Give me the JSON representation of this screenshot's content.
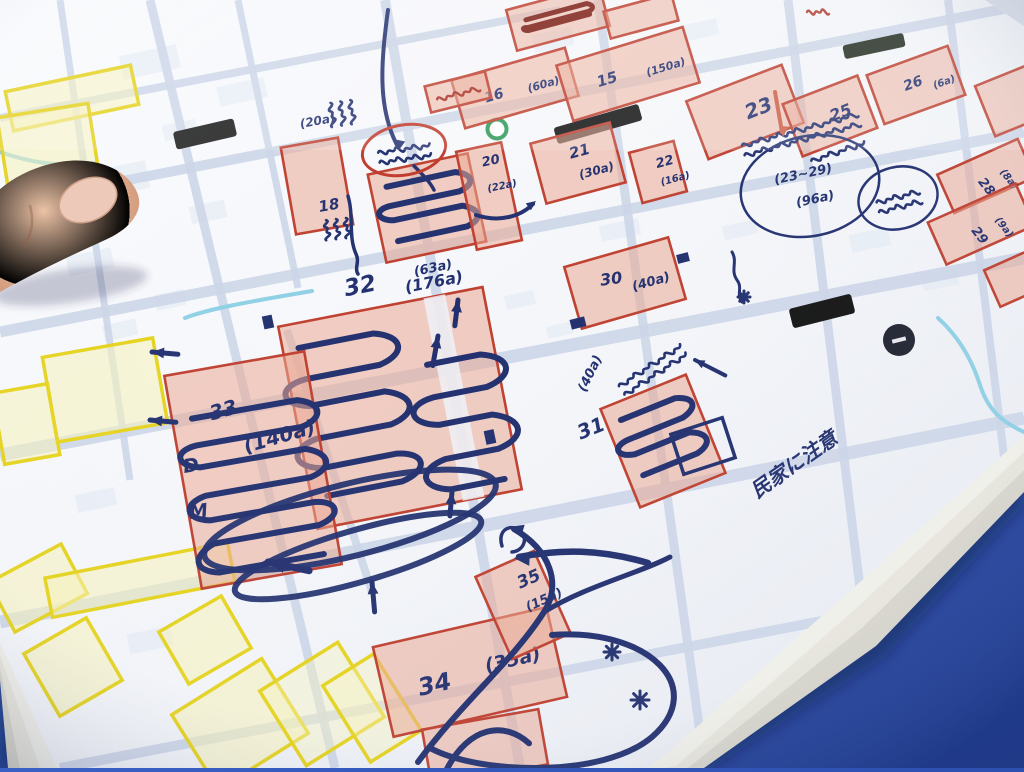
{
  "scene": {
    "description_labels": {
      "house_note": "民家に注意",
      "circle_note_line1": "(23~29)",
      "circle_note_line2": "(96a)",
      "letter_d": "D",
      "letter_m": "M"
    },
    "colors": {
      "table_blue": "#2a4cae",
      "paper": "#f6f7fa",
      "road": "#ccd6e8",
      "river": "#8fd0e6",
      "pink_fill": "#eba792",
      "pink_border": "#bf4030",
      "yellow_fill": "#f8f2b8",
      "yellow_border": "#e6d31d",
      "ink_navy": "#22306f",
      "red_ink": "#c0392b",
      "dark_red_marker": "#7c1d12"
    }
  },
  "map": {
    "parcels": [
      {
        "num": "16",
        "area": "(60a)",
        "cx": 515,
        "cy": 88,
        "w": 118,
        "h": 50,
        "rot": -16,
        "numPos": [
          -32,
          6,
          14,
          0
        ],
        "areaPos": [
          12,
          8,
          11,
          0
        ]
      },
      {
        "num": "15",
        "area": "(150a)",
        "cx": 628,
        "cy": 74,
        "w": 132,
        "h": 58,
        "rot": -17,
        "numPos": [
          -32,
          4,
          15,
          0
        ],
        "areaPos": [
          18,
          8,
          11,
          0
        ]
      },
      {
        "num": "18",
        "area": "(20a)",
        "cx": 317,
        "cy": 186,
        "w": 58,
        "h": 88,
        "rot": -10,
        "numPos": [
          -2,
          26,
          15,
          0
        ],
        "areaPos": [
          -6,
          -60,
          12,
          0
        ]
      },
      {
        "num": "",
        "area": "(63a)",
        "cx": 427,
        "cy": 208,
        "w": 102,
        "h": 90,
        "rot": -12,
        "areaPos": [
          -26,
          64,
          13,
          0
        ],
        "scribbles": [
          {
            "dx": 0,
            "dy": -2,
            "w": 86,
            "h": 70,
            "runs": 4
          }
        ]
      },
      {
        "num": "20",
        "area": "(22a)",
        "cx": 489,
        "cy": 196,
        "w": 46,
        "h": 100,
        "rot": -12,
        "numPos": [
          0,
          -30,
          13,
          0
        ],
        "areaPos": [
          0,
          -4,
          10,
          0
        ]
      },
      {
        "num": "21",
        "area": "(30a)",
        "cx": 578,
        "cy": 163,
        "w": 82,
        "h": 62,
        "rot": -15,
        "numPos": [
          -6,
          -6,
          15,
          0
        ],
        "areaPos": [
          -2,
          16,
          12,
          0
        ]
      },
      {
        "num": "22",
        "area": "(16a)",
        "cx": 658,
        "cy": 172,
        "w": 46,
        "h": 52,
        "rot": -15,
        "numPos": [
          0,
          -4,
          13,
          0
        ],
        "areaPos": [
          0,
          14,
          10,
          0
        ]
      },
      {
        "num": "23",
        "area": "",
        "cx": 745,
        "cy": 112,
        "w": 102,
        "h": 62,
        "rot": -21,
        "numPos": [
          0,
          8,
          20,
          0
        ]
      },
      {
        "num": "25",
        "area": "",
        "cx": 830,
        "cy": 116,
        "w": 80,
        "h": 56,
        "rot": -21,
        "numPos": [
          0,
          6,
          16,
          0
        ]
      },
      {
        "num": "26",
        "area": "(6a)",
        "cx": 916,
        "cy": 85,
        "w": 86,
        "h": 52,
        "rot": -20,
        "numPos": [
          -12,
          2,
          14,
          0
        ],
        "areaPos": [
          16,
          10,
          10,
          0
        ]
      },
      {
        "num": "28",
        "area": "(8a)",
        "cx": 986,
        "cy": 176,
        "w": 88,
        "h": 42,
        "rot": -24,
        "numPos": [
          -10,
          2,
          13,
          76
        ],
        "areaPos": [
          14,
          2,
          10,
          76
        ]
      },
      {
        "num": "29",
        "area": "(9a)",
        "cx": 981,
        "cy": 224,
        "w": 96,
        "h": 46,
        "rot": -24,
        "numPos": [
          -12,
          2,
          13,
          76
        ],
        "areaPos": [
          14,
          2,
          10,
          76
        ]
      },
      {
        "num": "",
        "area": "",
        "cx": 1013,
        "cy": 100,
        "w": 60,
        "h": 54,
        "rot": -22
      },
      {
        "num": "30",
        "area": "(40a)",
        "cx": 625,
        "cy": 283,
        "w": 108,
        "h": 64,
        "rot": -16,
        "numPos": [
          -24,
          -4,
          16,
          8
        ],
        "areaPos": [
          6,
          10,
          13,
          0
        ]
      },
      {
        "num": "31",
        "area": "(40a)",
        "cx": 663,
        "cy": 441,
        "w": 92,
        "h": 106,
        "rot": -22,
        "numPos": [
          -76,
          -32,
          20,
          0
        ],
        "areaPos": [
          -54,
          -74,
          13,
          -42
        ],
        "scribbles": [
          {
            "dx": -2,
            "dy": -6,
            "w": 74,
            "h": 74,
            "runs": 4
          }
        ]
      },
      {
        "num": "32",
        "area": "(176a)",
        "cx": 400,
        "cy": 408,
        "w": 208,
        "h": 206,
        "rot": -11,
        "numPos": [
          -32,
          -120,
          23,
          0
        ],
        "areaPos": [
          28,
          -112,
          16,
          0
        ],
        "gap": true,
        "scribbles": [
          {
            "dx": -50,
            "dy": -2,
            "w": 92,
            "h": 168,
            "runs": 6
          },
          {
            "dx": 62,
            "dy": 26,
            "w": 70,
            "h": 142,
            "runs": 5
          }
        ]
      },
      {
        "num": "33",
        "area": "(140a)",
        "cx": 253,
        "cy": 470,
        "w": 142,
        "h": 216,
        "rot": -10,
        "numPos": [
          -32,
          -56,
          20,
          -6
        ],
        "areaPos": [
          -4,
          -18,
          20,
          -6
        ],
        "scribbles": [
          {
            "dx": 2,
            "dy": 16,
            "w": 122,
            "h": 170,
            "runs": 7
          }
        ]
      },
      {
        "num": "34",
        "area": "(35a)",
        "cx": 470,
        "cy": 672,
        "w": 178,
        "h": 92,
        "rot": -13,
        "numPos": [
          -54,
          12,
          24,
          0
        ],
        "areaPos": [
          16,
          4,
          19,
          0
        ]
      },
      {
        "num": "35",
        "area": "(15a)",
        "cx": 523,
        "cy": 605,
        "w": 64,
        "h": 90,
        "rot": -24,
        "numPos": [
          4,
          -16,
          17,
          0
        ],
        "areaPos": [
          2,
          8,
          13,
          0
        ]
      },
      {
        "num": "",
        "area": "",
        "cx": 558,
        "cy": 18,
        "w": 96,
        "h": 42,
        "rot": -15,
        "darkScribble": true
      },
      {
        "num": "",
        "area": "",
        "cx": 641,
        "cy": 16,
        "w": 70,
        "h": 28,
        "rot": -15
      },
      {
        "num": "",
        "area": "",
        "cx": 458,
        "cy": 92,
        "w": 62,
        "h": 27,
        "rot": -14,
        "redText": true
      },
      {
        "num": "",
        "area": "",
        "cx": 485,
        "cy": 747,
        "w": 118,
        "h": 56,
        "rot": -10,
        "arc": true
      },
      {
        "num": "",
        "area": "",
        "cx": 1016,
        "cy": 278,
        "w": 52,
        "h": 40,
        "rot": -24
      }
    ],
    "yellow_parcels": [
      [
        72,
        98,
        128,
        40,
        -12
      ],
      [
        50,
        158,
        92,
        96,
        -9
      ],
      [
        105,
        390,
        112,
        86,
        -10
      ],
      [
        26,
        424,
        56,
        72,
        -10
      ],
      [
        38,
        588,
        82,
        56,
        -28
      ],
      [
        140,
        580,
        186,
        40,
        -11
      ],
      [
        73,
        667,
        72,
        72,
        -30
      ],
      [
        205,
        640,
        72,
        60,
        -30
      ],
      [
        240,
        724,
        106,
        88,
        -32
      ],
      [
        322,
        704,
        92,
        88,
        -32,
        0.4
      ],
      [
        372,
        708,
        60,
        90,
        -32,
        0.4
      ]
    ],
    "roads": [
      [
        0,
        205,
        1024,
        5,
        10
      ],
      [
        0,
        118,
        560,
        10,
        8
      ],
      [
        0,
        332,
        1024,
        132,
        11
      ],
      [
        0,
        455,
        1024,
        258,
        13
      ],
      [
        0,
        622,
        1024,
        418,
        13
      ],
      [
        60,
        768,
        1024,
        582,
        10
      ],
      [
        150,
        0,
        335,
        768,
        9
      ],
      [
        385,
        0,
        520,
        768,
        10
      ],
      [
        287,
        330,
        372,
        592,
        8
      ],
      [
        598,
        0,
        705,
        768,
        9
      ],
      [
        788,
        0,
        882,
        768,
        9
      ],
      [
        948,
        0,
        1024,
        620,
        8
      ],
      [
        60,
        0,
        130,
        480,
        7
      ],
      [
        238,
        0,
        298,
        288,
        7
      ]
    ],
    "rivers": [
      "M185,318 C210,308 260,300 312,291",
      "M938,318 C958,336 972,360 980,385 C988,410 1002,422 1024,432",
      "M0,152 C24,160 52,168 96,163"
    ],
    "bars": [
      [
        205,
        134,
        62,
        18,
        -13,
        "#141414"
      ],
      [
        598,
        124,
        88,
        17,
        -16,
        "#101010"
      ],
      [
        822,
        311,
        64,
        20,
        -14,
        "#141414"
      ],
      [
        874,
        46,
        62,
        14,
        -12,
        "#20291c"
      ]
    ],
    "green_circle": [
      497,
      129,
      9.5
    ],
    "dark_circle": [
      899,
      340,
      16
    ],
    "red_arrow": {
      "line": [
        775,
        92,
        782,
        132
      ],
      "head": [
        783,
        137,
        95
      ]
    },
    "routes": [
      {
        "d": "M388,10 C381,62 377,108 398,147",
        "w": 4,
        "head": [
          399,
          150,
          102
        ]
      },
      {
        "d": "M414,166 C424,176 430,182 434,190",
        "w": 3.5
      },
      {
        "d": "M418,762 C464,700 512,662 544,612 C562,584 550,550 514,529",
        "w": 6,
        "head": [
          509,
          527,
          196
        ]
      },
      {
        "d": "M544,612 C586,586 640,573 670,557",
        "w": 5
      },
      {
        "d": "M648,563 C600,549 561,549 519,557",
        "w": 6.5,
        "head": [
          514,
          558,
          183
        ]
      },
      {
        "d": "M552,635 C650,628 708,688 652,737 C602,779 478,774 430,748",
        "w": 6
      },
      {
        "d": "M476,215 C500,223 521,216 533,204",
        "w": 4,
        "head": [
          536,
          201,
          -37
        ]
      },
      {
        "d": "M502,546 C497,530 510,523 520,531 C529,539 523,551 512,552",
        "w": 3.5
      },
      {
        "d": "M732,252 C738,262 730,270 737,280 C743,288 736,294 742,302",
        "w": 3
      },
      {
        "d": "M348,196 C354,216 348,236 356,254 C360,262 354,268 358,274",
        "w": 3.5
      }
    ],
    "arrows": [
      [
        152,
        352,
        185,
        26,
        5
      ],
      [
        150,
        420,
        185,
        26,
        5
      ],
      [
        268,
        562,
        192,
        42,
        7
      ],
      [
        438,
        336,
        -80,
        30,
        5
      ],
      [
        458,
        300,
        -83,
        26,
        5
      ],
      [
        372,
        582,
        -95,
        30,
        5
      ],
      [
        695,
        360,
        207,
        34,
        4
      ],
      [
        452,
        492,
        -85,
        24,
        5
      ]
    ],
    "asterisks": [
      [
        612,
        652,
        16
      ],
      [
        640,
        700,
        18
      ],
      [
        744,
        297,
        12
      ]
    ],
    "squares": [
      [
        268,
        322,
        10,
        13,
        -12
      ],
      [
        490,
        437,
        10,
        14,
        -12
      ],
      [
        578,
        323,
        15,
        10,
        -14
      ],
      [
        683,
        258,
        12,
        9,
        -14
      ]
    ],
    "scribble_texts": [
      [
        352,
        112,
        24,
        3,
        82
      ],
      [
        347,
        228,
        20,
        3,
        84
      ],
      [
        800,
        130,
        120,
        2,
        -15
      ],
      [
        650,
        366,
        74,
        2,
        -33
      ],
      [
        404,
        149,
        52,
        2,
        -8
      ],
      [
        898,
        197,
        44,
        2,
        -14
      ],
      [
        838,
        152,
        56,
        1,
        -18
      ]
    ],
    "red_scribble": [
      818,
      12,
      22
    ],
    "ellipses": [
      {
        "cx": 404,
        "cy": 150,
        "rx": 42,
        "ry": 25,
        "rot": -10,
        "stroke": "#c0392b",
        "w": 3,
        "name": "red-circled-landmark"
      },
      {
        "cx": 810,
        "cy": 186,
        "rx": 70,
        "ry": 50,
        "rot": -12,
        "stroke": "#22306f",
        "w": 2.5,
        "name": "circled-summary-note"
      },
      {
        "cx": 898,
        "cy": 198,
        "rx": 40,
        "ry": 31,
        "rot": -14,
        "stroke": "#22306f",
        "w": 2.5,
        "name": "circled-scribble-note"
      }
    ],
    "loops": [
      [
        350,
        520,
        150,
        36,
        -14
      ],
      [
        358,
        556,
        128,
        26,
        -16
      ]
    ],
    "circle_note": {
      "line1_xy": [
        804,
        178,
        -12,
        13
      ],
      "line2_xy": [
        816,
        203,
        -12,
        13
      ]
    },
    "house_note_xy": [
      798,
      470,
      -35,
      20
    ],
    "letters": [
      [
        "D",
        184,
        473,
        19,
        -8
      ],
      [
        "M",
        190,
        519,
        19,
        -8
      ]
    ],
    "open_rect": [
      703,
      446,
      54,
      42,
      -18
    ]
  }
}
